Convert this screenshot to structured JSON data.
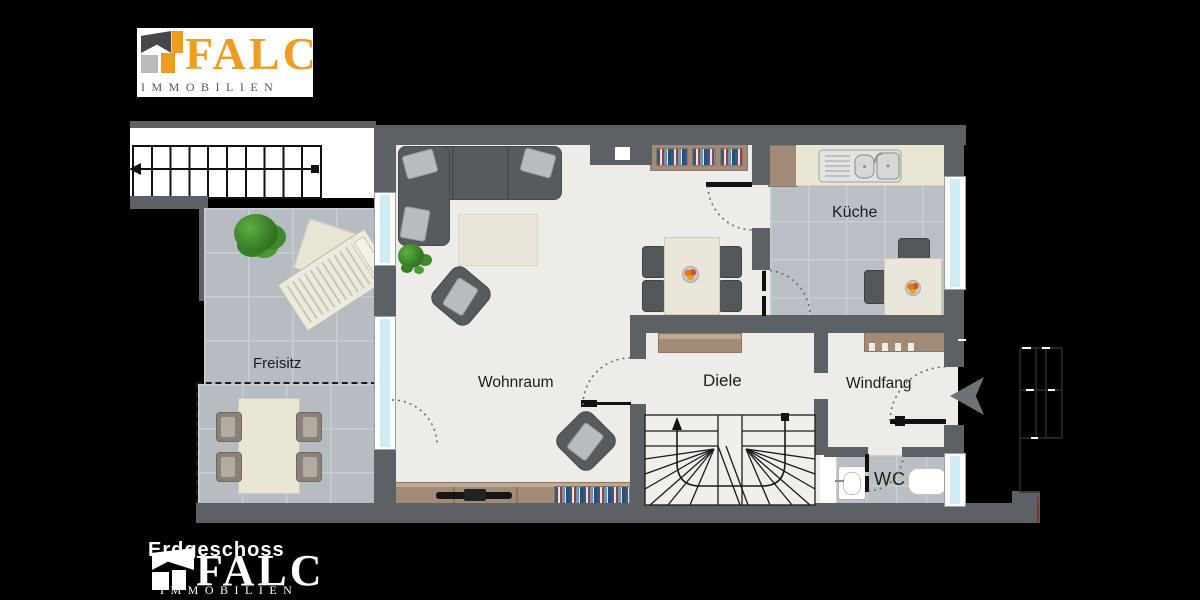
{
  "canvas": {
    "width": 1200,
    "height": 600,
    "background": "#000000"
  },
  "branding_top": {
    "name": "FALC",
    "subtitle": "IMMOBILIEN"
  },
  "branding_bottom": {
    "floor_label": "Erdgeschoss",
    "name": "FALC",
    "subtitle": "IMMOBILIEN"
  },
  "rooms": {
    "freisitz": {
      "label": "Freisitz"
    },
    "wohnraum": {
      "label": "Wohnraum"
    },
    "kueche": {
      "label": "Küche"
    },
    "diele": {
      "label": "Diele"
    },
    "windfang": {
      "label": "Windfang"
    },
    "wc": {
      "label": "WC"
    }
  },
  "colors": {
    "wall": "#5d6064",
    "floor": "#edece8",
    "tile": "#b7bdc3",
    "grout": "#c9ced3",
    "wood": "#a18b76",
    "cream": "#e9e5d4",
    "sofa": "#585b5e",
    "cushion": "#b9bcbe",
    "window_glass": "#cdeef5",
    "brand_orange": "#f09c1e",
    "brand_gray": "#56575b",
    "brand_lightgray": "#b9babc",
    "plant_green": "#479339",
    "label_text": "#1c1c1c"
  },
  "furniture": [
    "corner-sofa",
    "rug",
    "armchair",
    "sideboard-tv",
    "bookshelf",
    "dining-table",
    "kitchen-counter",
    "sink",
    "kitchen-table",
    "coat-rack",
    "hall-sideboard",
    "washbasin",
    "toilet",
    "sun-lounger",
    "terrace-table",
    "plant",
    "staircase"
  ]
}
